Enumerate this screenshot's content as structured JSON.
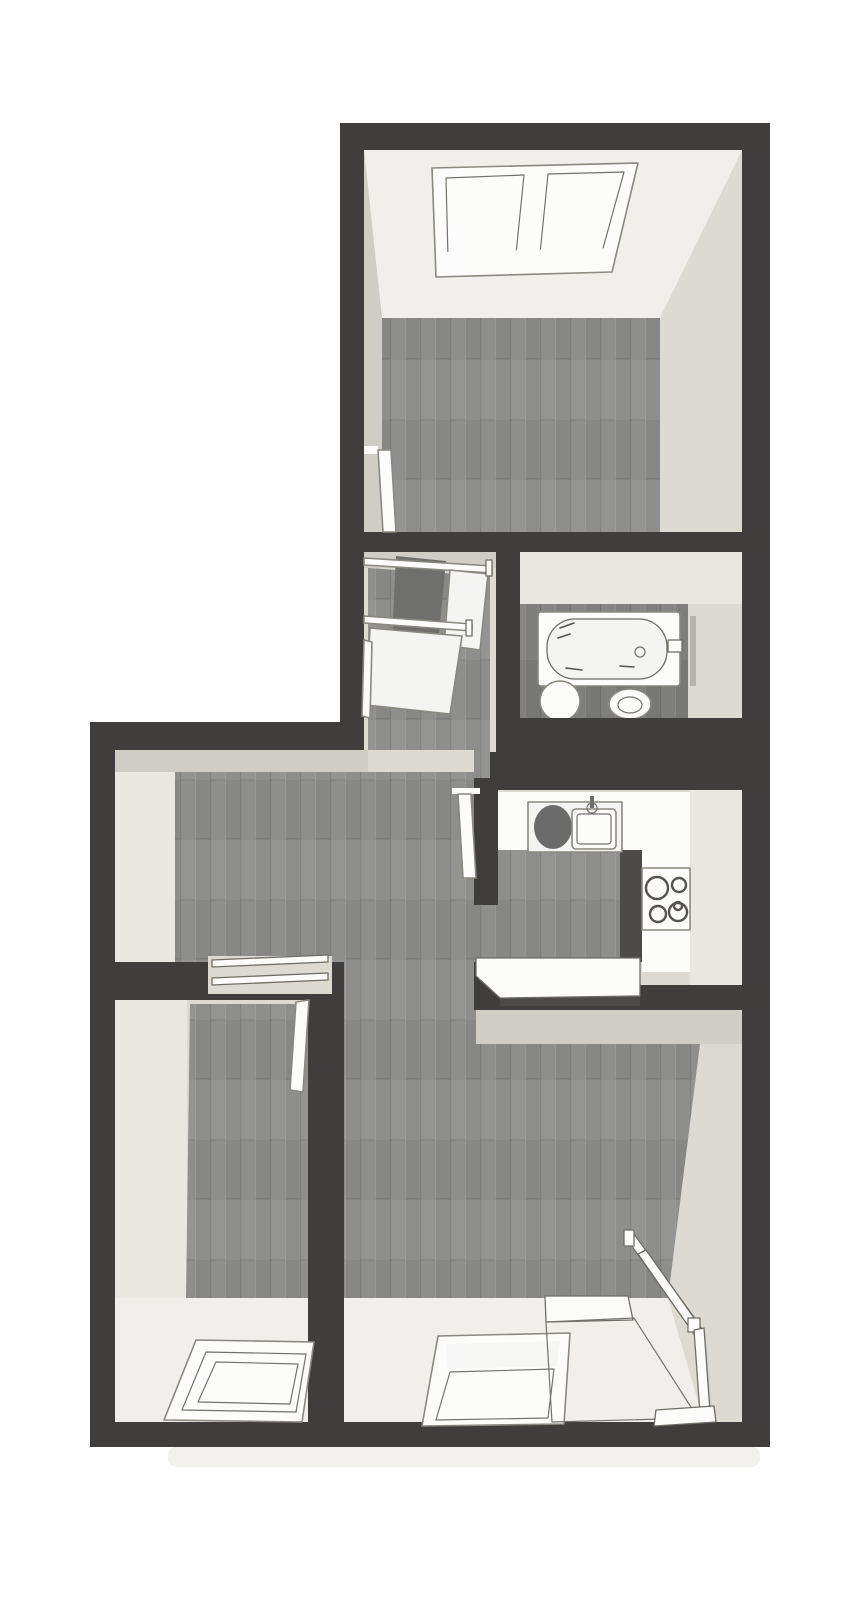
{
  "scene": {
    "kind": "3d-top-down-floor-plan",
    "visible_text": ""
  },
  "colors": {
    "background": "#ffffff",
    "page_shadow": "#f3f1ee",
    "wall": "#3f3e3d",
    "wall_shadow": "#4c4b49",
    "face_light": "#dcdad3",
    "face_mid": "#cfcdc6",
    "face_bright": "#e9e7e1",
    "ceiling_bright": "#f0efeb",
    "floor_wood": "#8e8e8c",
    "floor_wood_dark": "#7f7f7d",
    "stair_wood": "#6f6f6d",
    "fixture_white": "#fcfcfb",
    "fixture_fill": "#f4f4f2",
    "pane": "#f6f6f4",
    "steel_dark": "#6b6b69",
    "object_shadow": "#b7b5ae",
    "tile": "#a0a09e",
    "tile_grout": "#c6c6c4",
    "glass": "#c3c7c2",
    "plank_dark": "#000000",
    "plank_light": "#ffffff"
  }
}
